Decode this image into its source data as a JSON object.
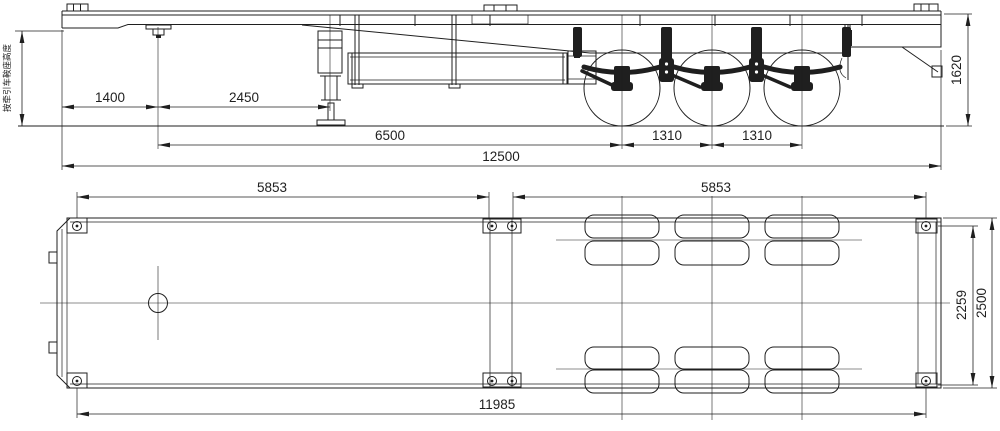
{
  "drawing": {
    "side_view": {
      "saddle_note": "按牵引车鞍座高度",
      "dim_front_overhang": "1400",
      "dim_kingpin_to_landing_gear": "2450",
      "dim_kingpin_to_first_axle": "6500",
      "dim_axle_spacing_1": "1310",
      "dim_axle_spacing_2": "1310",
      "dim_overall_length": "12500",
      "dim_rear_height": "1620"
    },
    "plan_view": {
      "dim_front_lock_span": "5853",
      "dim_rear_lock_span": "5853",
      "dim_lock_transverse": "2259",
      "dim_overall_width": "2500",
      "dim_lock_overall_length": "11985"
    },
    "colors": {
      "line": "#1f1f1f",
      "background": "#ffffff"
    }
  }
}
